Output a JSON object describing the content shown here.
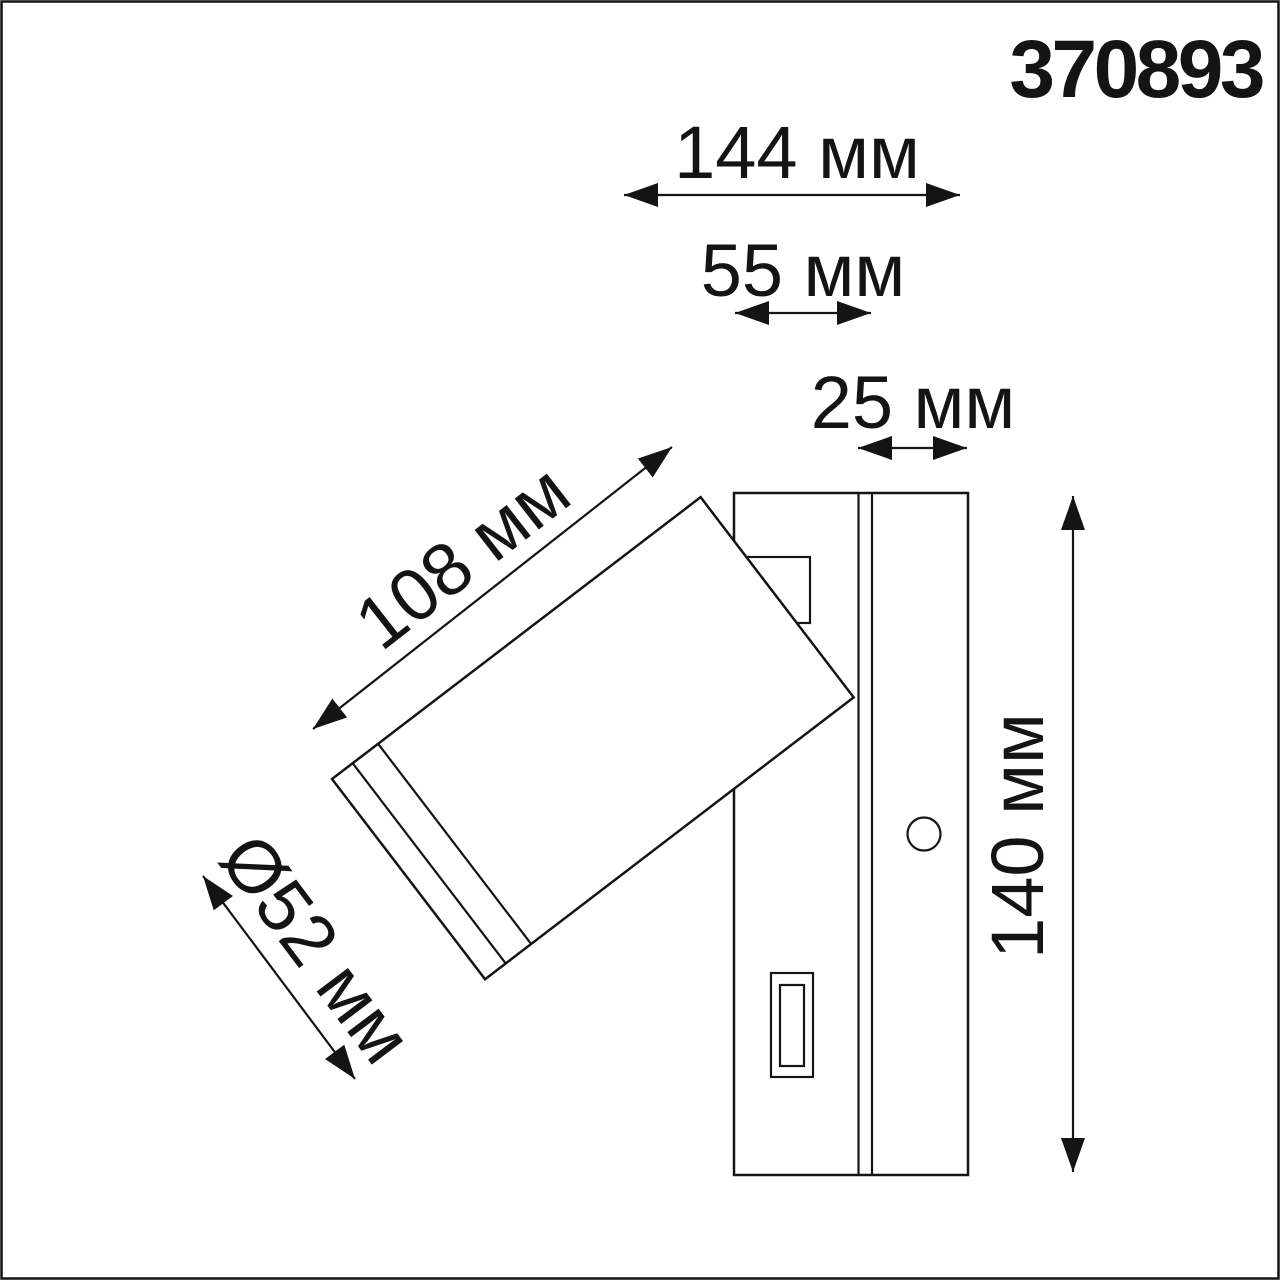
{
  "drawing": {
    "product_code": "370893",
    "dimensions": {
      "total_depth": {
        "label": "144 мм"
      },
      "housing_depth": {
        "label": "55 мм"
      },
      "plate_depth": {
        "label": "25 мм"
      },
      "head_length": {
        "label": "108 мм"
      },
      "head_diameter": {
        "label": "Ø52 мм"
      },
      "height": {
        "label": "140 мм"
      }
    },
    "colors": {
      "line": "#141414",
      "background": "#ffffff"
    }
  }
}
